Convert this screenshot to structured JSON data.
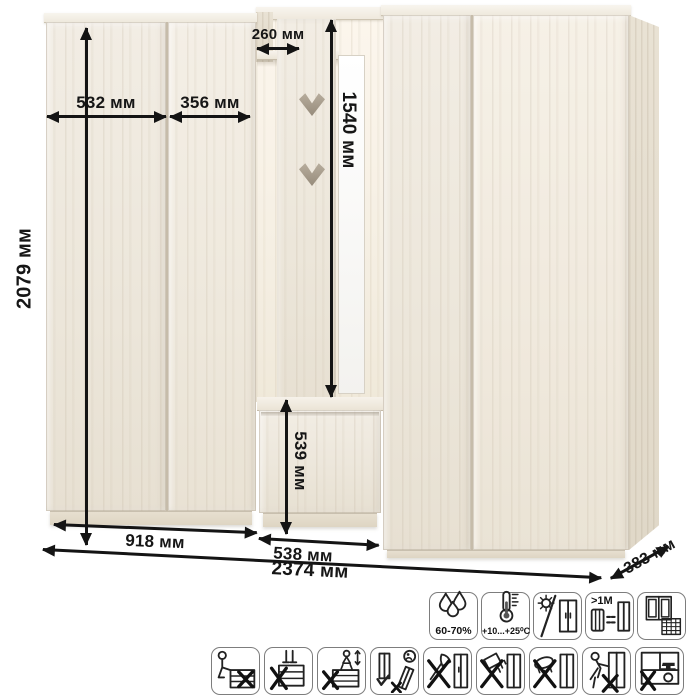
{
  "palette": {
    "wood": "#eee8dc",
    "arrow": "#141414",
    "mirror": "#fcfcfb"
  },
  "dimensions": {
    "total_height": "2079 мм",
    "left_door_width": "532 мм",
    "right_door_width": "356 мм",
    "shelf_depth": "260 мм",
    "open_section_height": "1540 мм",
    "bench_height": "539 мм",
    "left_module_width": "918 мм",
    "middle_module_width": "538 мм",
    "total_width": "2374 мм",
    "depth": "383 мм"
  },
  "care": {
    "row1": [
      {
        "name": "humidity",
        "label": "60-70%"
      },
      {
        "name": "temperature",
        "label": "+10...+25⁰C"
      },
      {
        "name": "no-direct-sunlight",
        "label": ""
      },
      {
        "name": "heat-distance",
        "label": ">1М"
      },
      {
        "name": "ventilation",
        "label": ""
      }
    ],
    "row2": [
      {
        "name": "no-sitting"
      },
      {
        "name": "no-standing"
      },
      {
        "name": "no-children-jumping"
      },
      {
        "name": "transport-upright-only"
      },
      {
        "name": "no-sharp-tools"
      },
      {
        "name": "no-liquid-spill"
      },
      {
        "name": "no-wet-cleaning"
      },
      {
        "name": "no-dragging"
      },
      {
        "name": "no-overloading"
      }
    ]
  }
}
